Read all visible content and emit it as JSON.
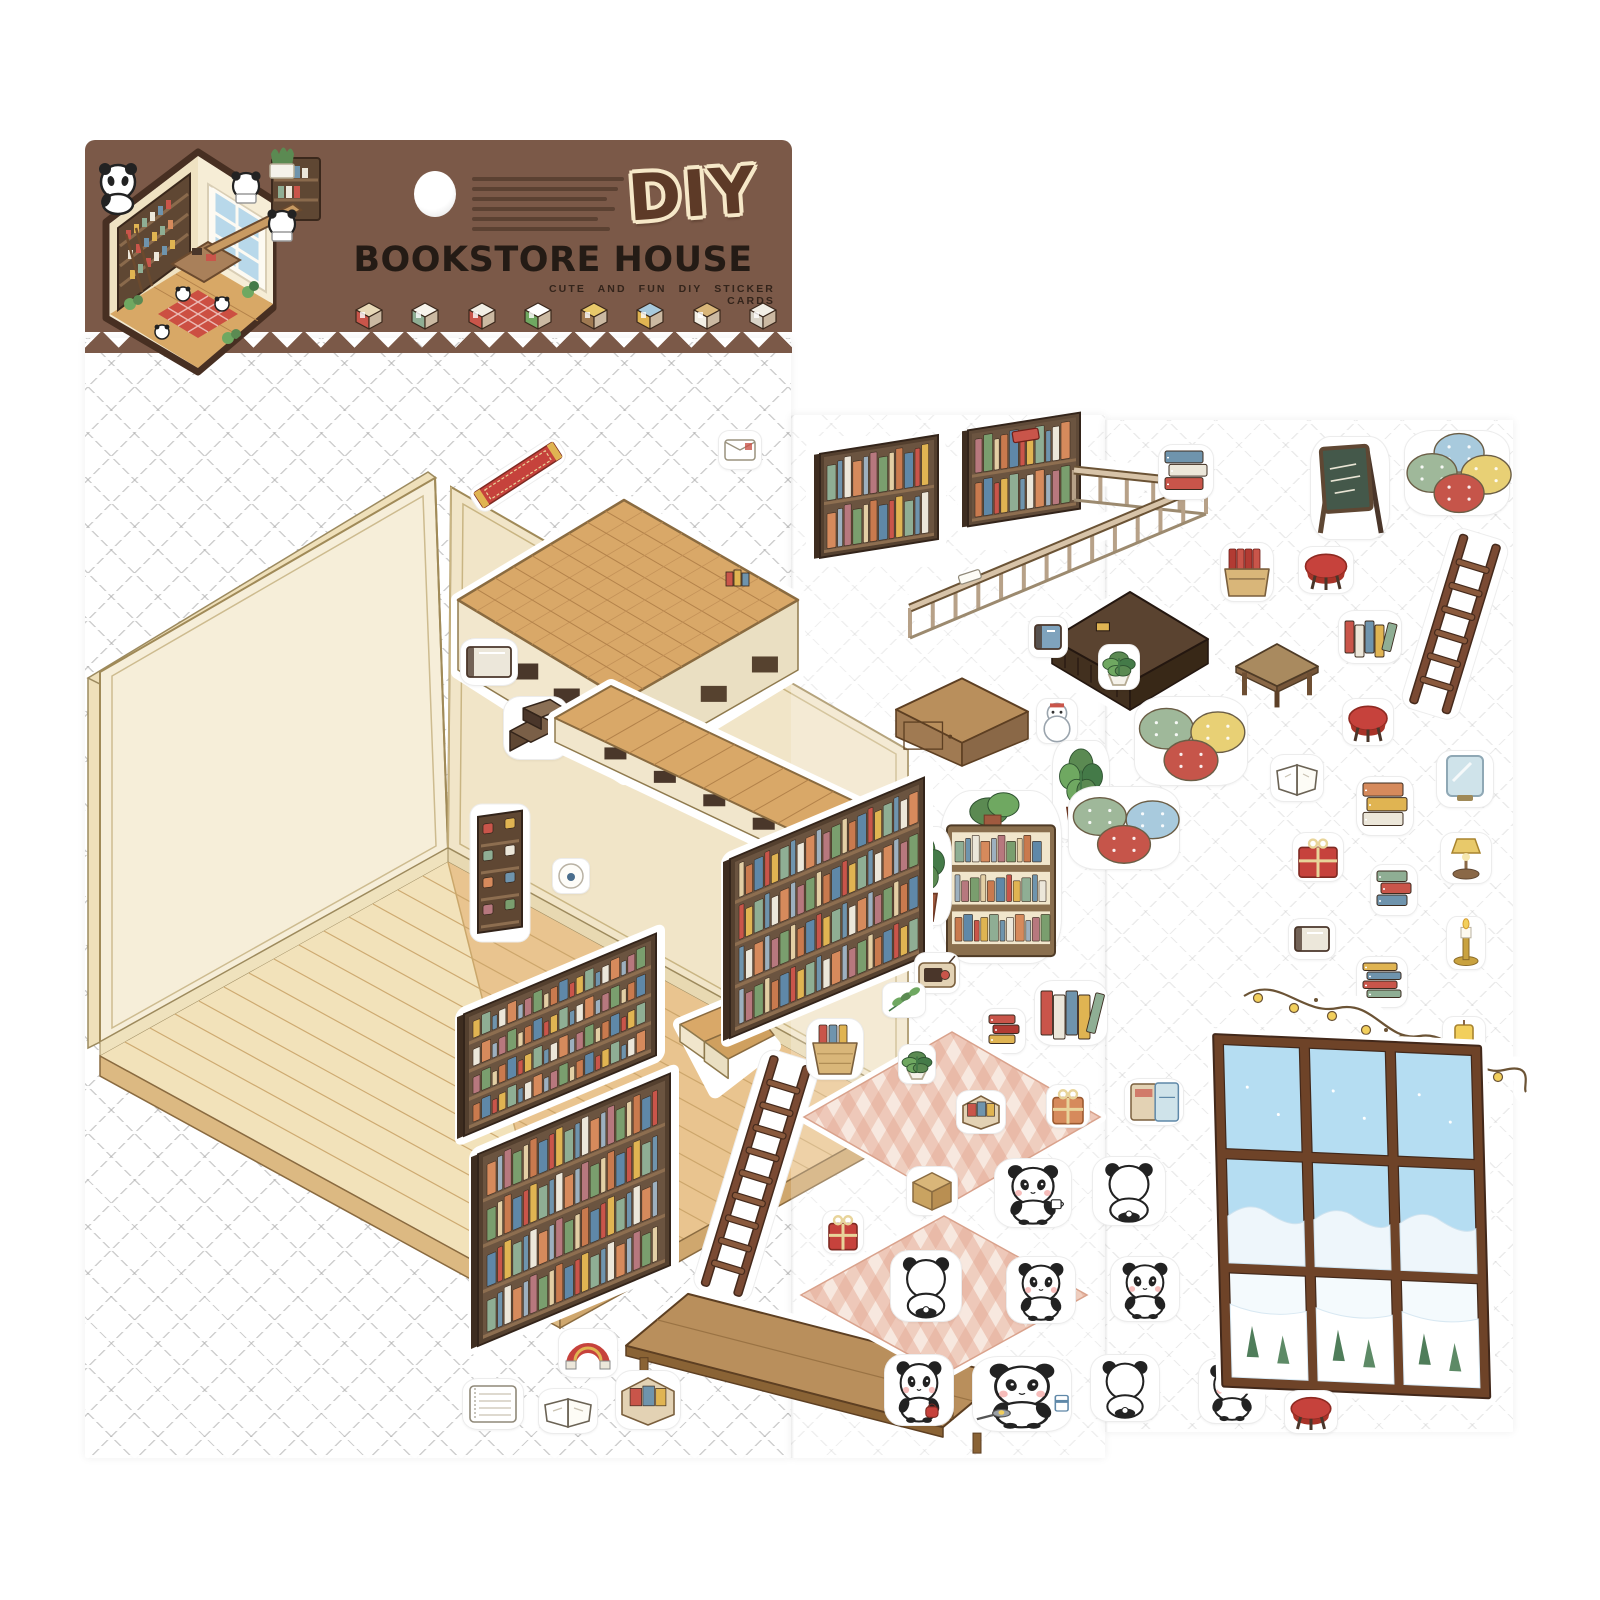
{
  "product": {
    "logo": "DIY",
    "title": "BOOKSTORE HOUSE",
    "subtitle": "CUTE AND FUN DIY STICKER CARDS",
    "description_legible": false,
    "description_line_count": 6
  },
  "colors": {
    "banner_brown": "#7b5948",
    "logo_fill": "#5d3a27",
    "logo_outline": "#f6e8c8",
    "title_black": "#241b15",
    "wall_cream": "#f6eed9",
    "wall_shade": "#f1e5c8",
    "floor_pale": "#f2e2ba",
    "floor_wood": "#e9c48f",
    "plank_wood": "#d9a868",
    "shelf_dark_brown": "#54402f",
    "rug_pink": "#e8b7a3",
    "window_sky_blue": "#b5ddf2",
    "frame_brown": "#6e4328",
    "panda_black": "#222222",
    "accent_red": "#c6423c",
    "accent_yellow": "#e0b452",
    "accent_green": "#8fae94",
    "accent_blue": "#6f94ad"
  },
  "header": {
    "hexagon_scene": "isometric-panda-bookstore-preview",
    "icons": [
      {
        "name": "bookshelf-mini-icon"
      },
      {
        "name": "paper-bag-mini-icon"
      },
      {
        "name": "cabinet-mini-icon"
      },
      {
        "name": "plant-mini-icon"
      },
      {
        "name": "lamp-mini-icon"
      },
      {
        "name": "locker-mini-icon"
      },
      {
        "name": "sideboard-mini-icon"
      },
      {
        "name": "sofa-mini-icon"
      }
    ]
  },
  "stickers": [
    {
      "n": "sticker-red-runner",
      "t": "runner",
      "x": 462,
      "y": 442,
      "w": 112,
      "h": 66
    },
    {
      "n": "sticker-loft-platform",
      "t": "platformA",
      "x": 452,
      "y": 486,
      "w": 352,
      "h": 312
    },
    {
      "n": "sticker-white-book",
      "t": "book",
      "x": 460,
      "y": 638,
      "w": 56,
      "h": 46,
      "v": "white"
    },
    {
      "n": "sticker-step-stool",
      "t": "steps",
      "x": 503,
      "y": 696,
      "w": 64,
      "h": 62
    },
    {
      "n": "sticker-wall-rack",
      "t": "rack",
      "x": 470,
      "y": 804,
      "w": 60,
      "h": 138
    },
    {
      "n": "sticker-tiny-ball",
      "t": "ball",
      "x": 552,
      "y": 858,
      "w": 36,
      "h": 34
    },
    {
      "n": "sticker-bookshelf-1",
      "t": "shelfiso",
      "x": 458,
      "y": 922,
      "w": 210,
      "h": 220,
      "v": "1"
    },
    {
      "n": "sticker-loft-walkway",
      "t": "walkway",
      "x": 545,
      "y": 660,
      "w": 420,
      "h": 255
    },
    {
      "n": "sticker-loft-steps",
      "t": "steps2",
      "x": 672,
      "y": 992,
      "w": 108,
      "h": 108
    },
    {
      "n": "sticker-bookshelf-2",
      "t": "shelfiso",
      "x": 472,
      "y": 1062,
      "w": 210,
      "h": 290,
      "v": "5"
    },
    {
      "n": "sticker-ladder-1",
      "t": "ladder",
      "x": 704,
      "y": 1048,
      "w": 104,
      "h": 256
    },
    {
      "n": "sticker-bench",
      "t": "bench",
      "x": 618,
      "y": 1268,
      "w": 395,
      "h": 185
    },
    {
      "n": "sticker-rainbow-magnet",
      "t": "magnet",
      "x": 558,
      "y": 1328,
      "w": 58,
      "h": 48
    },
    {
      "n": "sticker-notepad",
      "t": "notepad",
      "x": 462,
      "y": 1378,
      "w": 60,
      "h": 50
    },
    {
      "n": "sticker-open-book-1",
      "t": "openbook",
      "x": 538,
      "y": 1388,
      "w": 58,
      "h": 44
    },
    {
      "n": "sticker-craft-box",
      "t": "artbox",
      "x": 615,
      "y": 1370,
      "w": 64,
      "h": 58
    },
    {
      "n": "sticker-envelope",
      "t": "envelope",
      "x": 718,
      "y": 430,
      "w": 42,
      "h": 38
    },
    {
      "n": "sticker-loft-railing",
      "t": "railing",
      "x": 806,
      "y": 430,
      "w": 465,
      "h": 212
    },
    {
      "n": "sticker-blue-books",
      "t": "bookstack",
      "x": 1158,
      "y": 444,
      "w": 54,
      "h": 54,
      "v": "blue"
    },
    {
      "n": "sticker-book-crate",
      "t": "crate",
      "x": 1220,
      "y": 542,
      "w": 52,
      "h": 58
    },
    {
      "n": "sticker-dark-table",
      "t": "darktable",
      "x": 1046,
      "y": 582,
      "w": 168,
      "h": 136
    },
    {
      "n": "sticker-blue-book",
      "t": "book",
      "x": 1028,
      "y": 616,
      "w": 38,
      "h": 40,
      "v": "blue"
    },
    {
      "n": "sticker-snowman",
      "t": "snowman",
      "x": 1036,
      "y": 698,
      "w": 40,
      "h": 44
    },
    {
      "n": "sticker-plant-pot",
      "t": "plant",
      "x": 1098,
      "y": 644,
      "w": 40,
      "h": 44,
      "v": "small"
    },
    {
      "n": "sticker-sideboard",
      "t": "sideboard",
      "x": 888,
      "y": 668,
      "w": 148,
      "h": 104
    },
    {
      "n": "sticker-plant-1",
      "t": "plant",
      "x": 1052,
      "y": 740,
      "w": 56,
      "h": 98
    },
    {
      "n": "sticker-bookcase-plant",
      "t": "bookcase",
      "x": 940,
      "y": 790,
      "w": 120,
      "h": 172
    },
    {
      "n": "sticker-plant-2",
      "t": "plant",
      "x": 894,
      "y": 826,
      "w": 56,
      "h": 98
    },
    {
      "n": "sticker-bookshelf-3",
      "t": "shelfiso",
      "x": 724,
      "y": 766,
      "w": 212,
      "h": 278,
      "v": "9"
    },
    {
      "n": "sticker-radio",
      "t": "radio",
      "x": 914,
      "y": 952,
      "w": 44,
      "h": 40
    },
    {
      "n": "sticker-leaf-sprig",
      "t": "leaf",
      "x": 882,
      "y": 982,
      "w": 42,
      "h": 34
    },
    {
      "n": "sticker-basket-books",
      "t": "basket",
      "x": 806,
      "y": 1018,
      "w": 56,
      "h": 60
    },
    {
      "n": "sticker-red-books",
      "t": "bookstack",
      "x": 982,
      "y": 1008,
      "w": 42,
      "h": 44,
      "v": "red"
    },
    {
      "n": "sticker-small-books",
      "t": "bookscluster",
      "x": 1034,
      "y": 980,
      "w": 72,
      "h": 64
    },
    {
      "n": "sticker-gingham-rug-1",
      "t": "rug",
      "x": 796,
      "y": 1026,
      "w": 312,
      "h": 182
    },
    {
      "n": "sticker-rug-plant",
      "t": "plant",
      "x": 898,
      "y": 1044,
      "w": 36,
      "h": 38,
      "v": "small"
    },
    {
      "n": "sticker-rug-box",
      "t": "artbox",
      "x": 956,
      "y": 1090,
      "w": 48,
      "h": 42
    },
    {
      "n": "sticker-gift-basket",
      "t": "gift",
      "x": 1046,
      "y": 1084,
      "w": 42,
      "h": 42,
      "v": "orange"
    },
    {
      "n": "sticker-cardboard-box",
      "t": "box",
      "x": 906,
      "y": 1166,
      "w": 50,
      "h": 48
    },
    {
      "n": "sticker-gift-1",
      "t": "gift",
      "x": 822,
      "y": 1210,
      "w": 40,
      "h": 42
    },
    {
      "n": "sticker-gingham-rug-2",
      "t": "rug",
      "x": 793,
      "y": 1210,
      "w": 302,
      "h": 170
    },
    {
      "n": "sticker-panda-back-rug",
      "t": "panda",
      "x": 890,
      "y": 1250,
      "w": 70,
      "h": 70,
      "v": "back"
    },
    {
      "n": "sticker-panda-cup",
      "t": "panda",
      "x": 994,
      "y": 1158,
      "w": 76,
      "h": 68,
      "v": "cup"
    },
    {
      "n": "sticker-panda-back-1",
      "t": "panda",
      "x": 1092,
      "y": 1156,
      "w": 72,
      "h": 68,
      "v": "back"
    },
    {
      "n": "sticker-panda-sit-1",
      "t": "panda",
      "x": 1006,
      "y": 1256,
      "w": 68,
      "h": 66,
      "v": "face"
    },
    {
      "n": "sticker-panda-sit-2",
      "t": "panda",
      "x": 1110,
      "y": 1256,
      "w": 68,
      "h": 64,
      "v": "face"
    },
    {
      "n": "sticker-fridge",
      "t": "fridge",
      "x": 1124,
      "y": 1078,
      "w": 58,
      "h": 46
    },
    {
      "n": "sticker-panda-bag",
      "t": "panda",
      "x": 884,
      "y": 1354,
      "w": 68,
      "h": 70,
      "v": "bag"
    },
    {
      "n": "sticker-panda-cook",
      "t": "panda",
      "x": 972,
      "y": 1356,
      "w": 98,
      "h": 74,
      "v": "pan"
    },
    {
      "n": "sticker-panda-back-2",
      "t": "panda",
      "x": 1090,
      "y": 1354,
      "w": 68,
      "h": 66,
      "v": "back"
    },
    {
      "n": "sticker-panda-sit-3",
      "t": "panda",
      "x": 1198,
      "y": 1358,
      "w": 66,
      "h": 64,
      "v": "face"
    },
    {
      "n": "sticker-chalkboard",
      "t": "chalkboard",
      "x": 1310,
      "y": 436,
      "w": 78,
      "h": 102
    },
    {
      "n": "sticker-cushions-1",
      "t": "cushions",
      "x": 1404,
      "y": 430,
      "w": 104,
      "h": 84,
      "v": "four"
    },
    {
      "n": "sticker-stool-1",
      "t": "stool",
      "x": 1298,
      "y": 546,
      "w": 54,
      "h": 46
    },
    {
      "n": "sticker-ladder-2",
      "t": "ladder",
      "x": 1404,
      "y": 528,
      "w": 102,
      "h": 192
    },
    {
      "n": "sticker-books-bundle",
      "t": "bookscluster",
      "x": 1338,
      "y": 610,
      "w": 62,
      "h": 52
    },
    {
      "n": "sticker-low-table",
      "t": "table",
      "x": 1230,
      "y": 636,
      "w": 94,
      "h": 76
    },
    {
      "n": "sticker-stool-2",
      "t": "stool",
      "x": 1342,
      "y": 698,
      "w": 50,
      "h": 46
    },
    {
      "n": "sticker-cushions-2",
      "t": "cushions",
      "x": 1134,
      "y": 696,
      "w": 112,
      "h": 88,
      "v": "three_a"
    },
    {
      "n": "sticker-open-book-2",
      "t": "openbook",
      "x": 1270,
      "y": 754,
      "w": 52,
      "h": 46
    },
    {
      "n": "sticker-cushions-3",
      "t": "cushions",
      "x": 1068,
      "y": 786,
      "w": 110,
      "h": 82,
      "v": "three_b"
    },
    {
      "n": "sticker-mirror",
      "t": "mirror",
      "x": 1436,
      "y": 750,
      "w": 56,
      "h": 56
    },
    {
      "n": "sticker-orange-books",
      "t": "bookstack",
      "x": 1356,
      "y": 776,
      "w": 56,
      "h": 58,
      "v": "orange"
    },
    {
      "n": "sticker-gift-2",
      "t": "gift",
      "x": 1292,
      "y": 832,
      "w": 50,
      "h": 48
    },
    {
      "n": "sticker-book-pile-1",
      "t": "bookstack",
      "x": 1370,
      "y": 864,
      "w": 46,
      "h": 50,
      "v": "mixed"
    },
    {
      "n": "sticker-lamp",
      "t": "lamp",
      "x": 1440,
      "y": 832,
      "w": 50,
      "h": 50
    },
    {
      "n": "sticker-small-book",
      "t": "book",
      "x": 1288,
      "y": 918,
      "w": 46,
      "h": 40,
      "v": "white"
    },
    {
      "n": "sticker-candle",
      "t": "candle",
      "x": 1446,
      "y": 916,
      "w": 38,
      "h": 52
    },
    {
      "n": "sticker-book-pile-2",
      "t": "bookstack",
      "x": 1356,
      "y": 956,
      "w": 50,
      "h": 50,
      "v": "mixed2"
    },
    {
      "n": "sticker-garland",
      "t": "garland",
      "x": 1236,
      "y": 970,
      "w": 298,
      "h": 152
    },
    {
      "n": "sticker-lamp-small",
      "t": "lamp",
      "x": 1442,
      "y": 1016,
      "w": 42,
      "h": 42,
      "v": "small"
    },
    {
      "n": "sticker-window",
      "t": "windowb",
      "x": 1206,
      "y": 1016,
      "w": 292,
      "h": 404
    },
    {
      "n": "sticker-stool-3",
      "t": "stool",
      "x": 1284,
      "y": 1390,
      "w": 52,
      "h": 42
    }
  ]
}
